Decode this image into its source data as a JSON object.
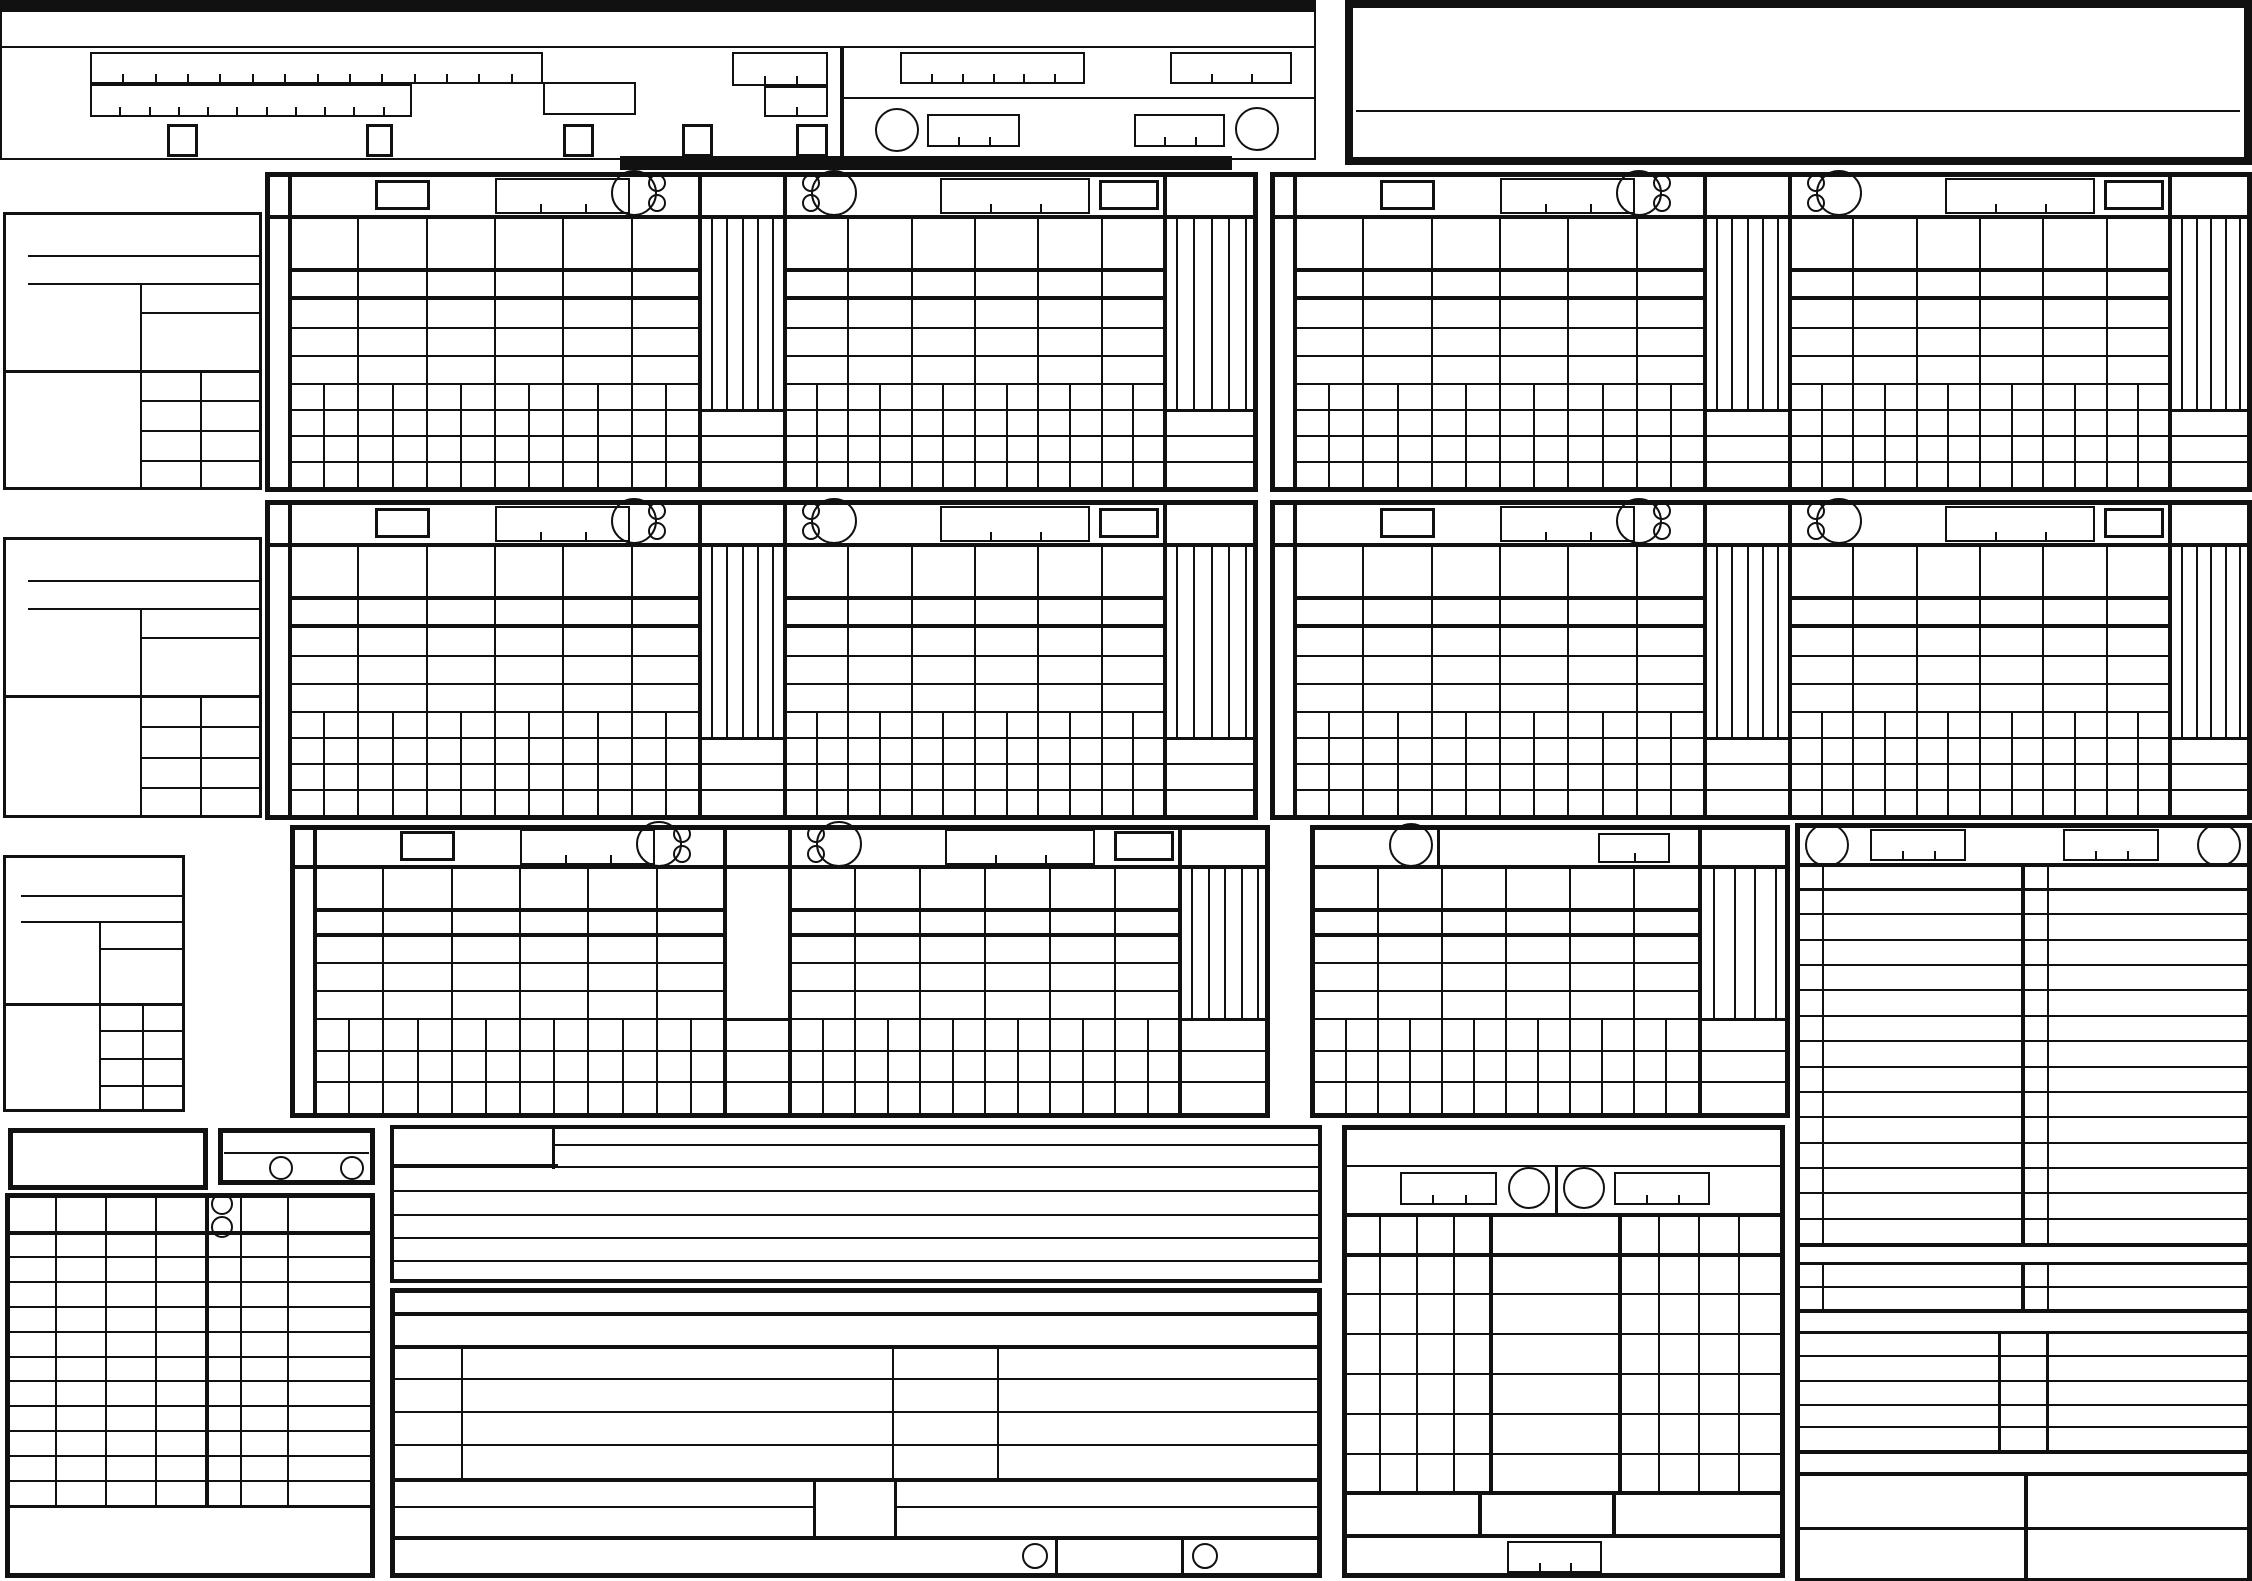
{
  "logo": {
    "brand": "FIVB",
    "trademark": "TM"
  },
  "palette": {
    "ink": "#111111",
    "paper": "#ffffff"
  },
  "form": {
    "set_panels": [
      "1",
      "2",
      "3",
      "4",
      "5"
    ],
    "team_sides": [
      "left",
      "right"
    ],
    "points_columns_per_strip": 4,
    "lineup_positions": 6,
    "service_subcolumns": 12,
    "roster_rows": 14,
    "libero_rows": 2,
    "official_rows": 5,
    "sanction_rows": 11,
    "result_rows": 6,
    "remark_lines": 5
  }
}
